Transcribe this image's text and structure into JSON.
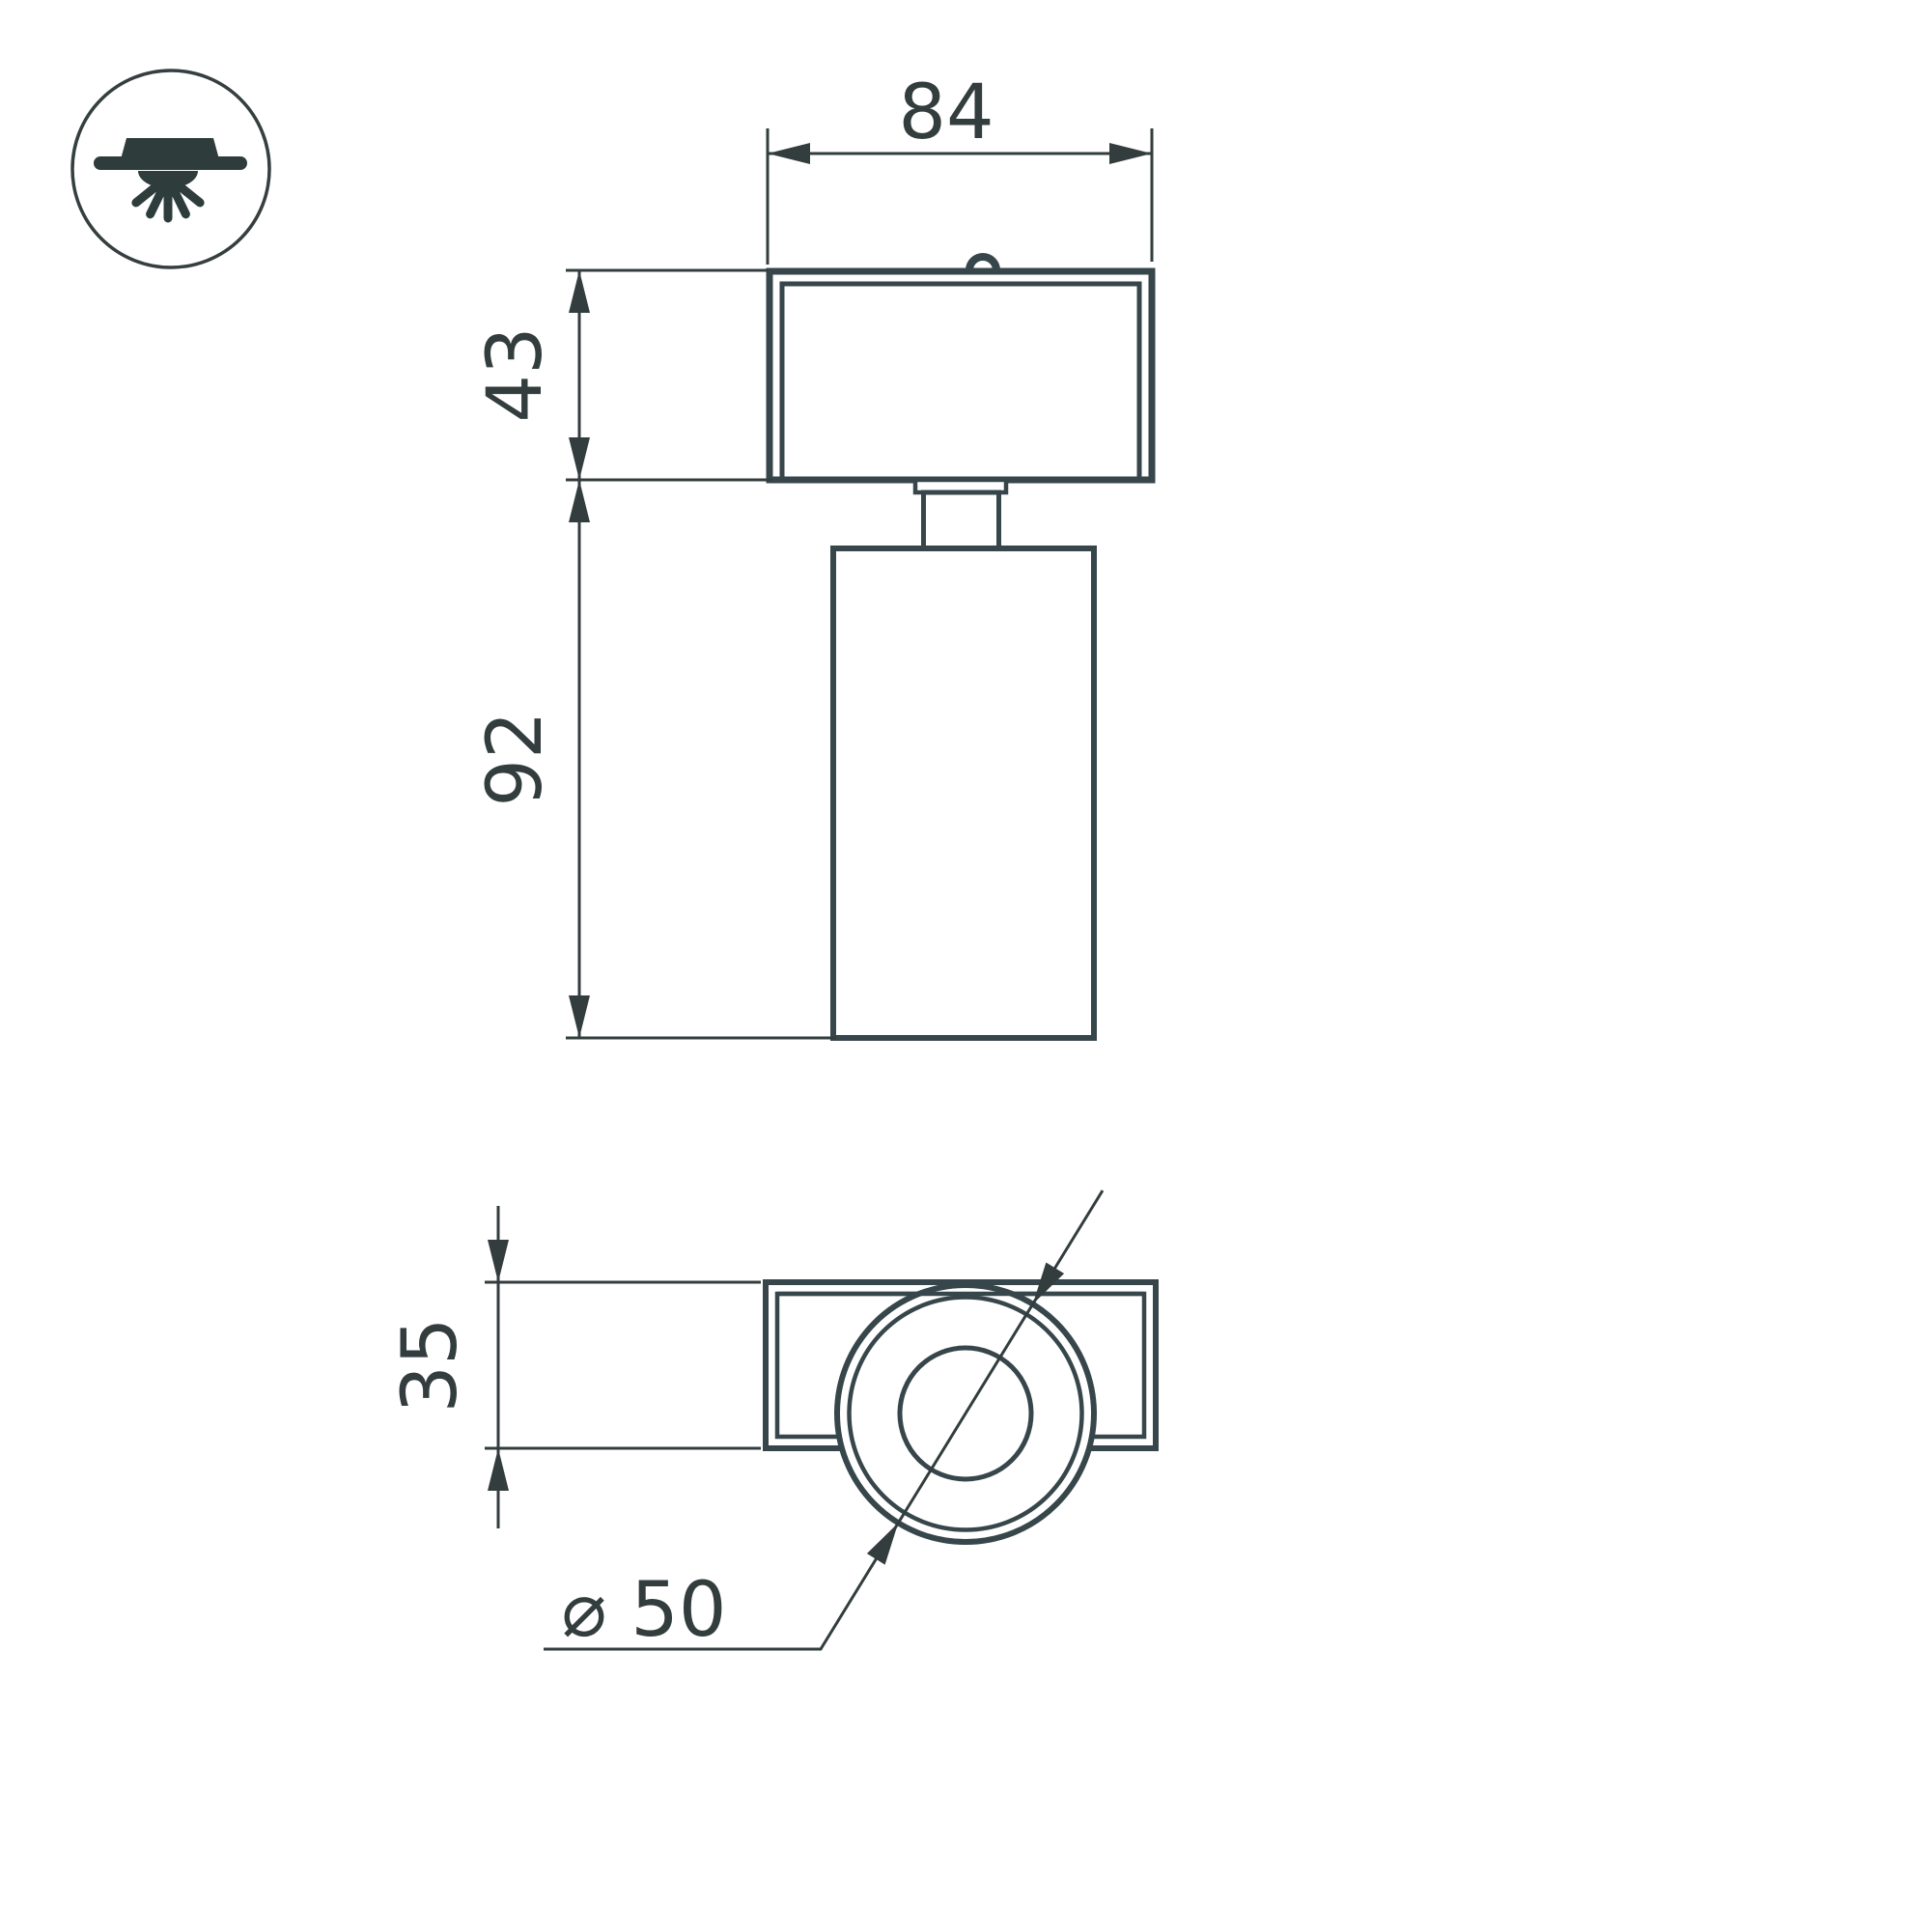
{
  "drawing": {
    "background": "#ffffff",
    "object_line_color": "#37464b",
    "dimension_line_color": "#333d3e",
    "text_color": "#333d3e",
    "icon_color": "#2e3c3c",
    "views": {
      "front_view": {
        "width_label": "84",
        "head_height_label": "43",
        "body_height_label": "92"
      },
      "bottom_view": {
        "depth_label": "35",
        "diameter_label": "⌀ 50"
      }
    },
    "icon": {
      "name": "ceiling-surface-mounted-light-icon"
    }
  }
}
